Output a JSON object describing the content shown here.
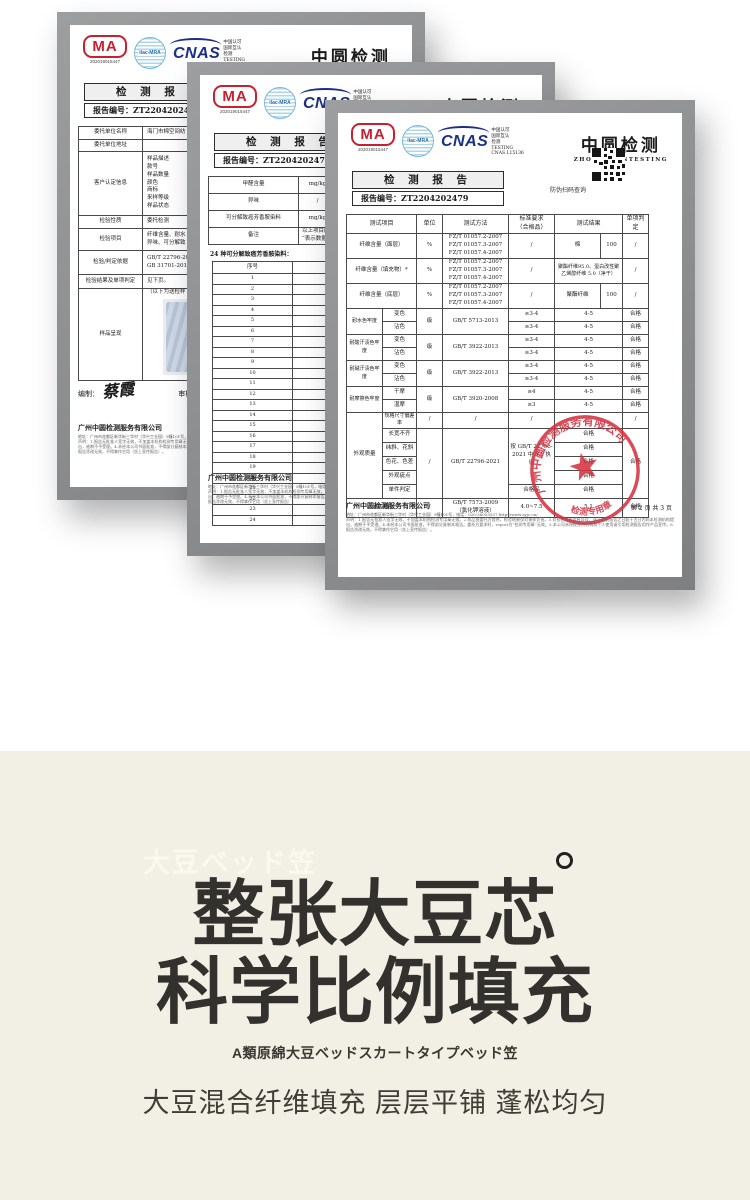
{
  "colors": {
    "cma_red": "#c8202f",
    "cnas_blue": "#1b2f86",
    "ilac_blue": "#79b7d8",
    "stamp_red": "#d5303f",
    "hero_bg": "#f2efe5",
    "hero_title": "#32312d"
  },
  "cert_common": {
    "cma_label": "MA",
    "cma_number": "202019015447",
    "ilac_label": "ilac-MRA",
    "cnas_label": "CNAS",
    "cnas_side_text": "中国认可\n国际互认\n检测\nTESTING\nCNAS L15136",
    "brand": "中圆检测",
    "brand_en": "ZHONGYUANTESTING",
    "report_title": "检 测 报 告",
    "report_no_label": "报告编号：",
    "report_no": "ZT2204202479",
    "qr_caption": "防伪扫码查询",
    "footer_company": "广州中圆检测服务有限公司",
    "footer_address": "地址：广州市花都区新华街三华村（华兴工业园）5幢101号，电话：020-36055537  http://www.zyjc.cn/",
    "footer_disclaimer": "声明：1.报告无批准人签字无效，不加盖本机构检测专用章无效。2.样品由委托方提供，检验结果仅对来样负责。3.对检验报告若有异议，请于收到报告之日起十五日内向本检测机构提出，逾期不予受理。4.未经本公司书面批准，不得部分复制本报告。委托方要求时，report为“检测专用章”无效。5.本公司未授权任何机构和个人使用或引用检测报告用作产品宣传。6.报告涂改无效，不得拿作它用（含上宣传报告）。",
    "page_info": "第 2 页 共 3 页"
  },
  "front": {
    "headers": [
      "测试项目",
      "单位",
      "测试方法",
      "标准要求\n（合格品）",
      "测试结果",
      "单项判定"
    ],
    "fiber_method": "FZ/T 01057.2-2007\nFZ/T 01057.3-2007\nFZ/T 01057.4-2007",
    "fiber": [
      {
        "item": "纤维含量（面层）",
        "unit": "%",
        "req": "/",
        "result_name": "棉",
        "result_val": "100",
        "judge": "/"
      },
      {
        "item": "纤维含量（填充物）*",
        "unit": "%",
        "req": "/",
        "result": "聚酯纤维95.0、蛋白改性聚乙烯醇纤维 5.0（净干）",
        "judge": "/"
      },
      {
        "item": "纤维含量（底层）",
        "unit": "%",
        "req": "/",
        "result_name": "聚酯纤维",
        "result_val": "100",
        "judge": "/"
      }
    ],
    "fastness": [
      {
        "group": "耐水色牢度",
        "unit": "级",
        "method": "GB/T 5713-2013",
        "sub1": "变色",
        "req1": "≥3-4",
        "res1": "4-5",
        "j1": "合格",
        "sub2": "沾色",
        "req2": "≥3-4",
        "res2": "4-5",
        "j2": "合格"
      },
      {
        "group": "耐酸汗渍色牢度",
        "unit": "级",
        "method": "GB/T 3922-2013",
        "sub1": "变色",
        "req1": "≥3-4",
        "res1": "4-5",
        "j1": "合格",
        "sub2": "沾色",
        "req2": "≥3-4",
        "res2": "4-5",
        "j2": "合格"
      },
      {
        "group": "耐碱汗渍色牢度",
        "unit": "级",
        "method": "GB/T 3922-2013",
        "sub1": "变色",
        "req1": "≥3-4",
        "res1": "4-5",
        "j1": "合格",
        "sub2": "沾色",
        "req2": "≥3-4",
        "res2": "4-5",
        "j2": "合格"
      },
      {
        "group": "耐摩擦色牢度",
        "unit": "级",
        "method": "GB/T 3920-2008",
        "sub1": "干摩",
        "req1": "≥4",
        "res1": "4-5",
        "j1": "合格",
        "sub2": "湿摩",
        "req2": "≥3",
        "res2": "4-5",
        "j2": "合格"
      }
    ],
    "appearance": {
      "group": "外观质量",
      "row0": {
        "item": "规格尺寸偏差率",
        "unit": "/",
        "method": "/",
        "req": "/",
        "result": "/",
        "judge": "/"
      },
      "items": [
        "长宽不齐",
        "纬斜、花斜",
        "色花、色差",
        "外观疵点",
        "单件判定"
      ],
      "unit": "/",
      "method": "GB/T 22796-2021",
      "req": "按 GB/T 22796-2021 中 4.6 执行",
      "results": [
        "合格",
        "合格",
        "合格",
        "合格",
        "合格"
      ],
      "final_req": "合格品",
      "judge": "合格"
    },
    "ph": {
      "item": "pH 值",
      "unit": "/",
      "method": "GB/T 7573-2009\n（氯化钾溶液）",
      "req": "4.0~7.5",
      "result": "5.1",
      "judge": "合格"
    },
    "stamp_ring_text": "广州中圆检测服务有限公司",
    "stamp_bottom_text": "检测专用章"
  },
  "middle": {
    "rows": [
      {
        "item": "甲醛含量",
        "unit": "mg/kg",
        "method": "GB/T 2912.1-2009\n（检出限20mg/kg）"
      },
      {
        "item": "异味",
        "unit": "/",
        "method": "GB 18401-2010"
      },
      {
        "item": "可分解致癌芳香胺染料",
        "unit": "mg/kg",
        "method": "GB/T 17592-2011"
      }
    ],
    "remark_label": "备注",
    "remark": "以上项目除纤维含量外\n“表示数据来自",
    "amine_caption": "24 种可分解致癌芳香胺染料：",
    "amine_headers": [
      "序号",
      "化学文摘号"
    ],
    "amine_rows": [
      [
        "1",
        "92-67-1"
      ],
      [
        "2",
        "92-87-5"
      ],
      [
        "3",
        "95-69-2"
      ],
      [
        "4",
        "91-59-8"
      ],
      [
        "5",
        "97-56-3"
      ],
      [
        "6",
        "106-47-8"
      ],
      [
        "7",
        "615-05-4"
      ],
      [
        "8",
        "101-77-9"
      ],
      [
        "9",
        "91-94-1"
      ],
      [
        "10",
        "119-90-4"
      ],
      [
        "11",
        "119-93-7"
      ],
      [
        "12",
        "838-88-0"
      ],
      [
        "13",
        "120-71-8"
      ],
      [
        "14",
        "101-14-4"
      ],
      [
        "15",
        "101-80-4"
      ],
      [
        "16",
        "139-65-1"
      ],
      [
        "17",
        "95-53-4"
      ],
      [
        "18",
        "95-80-7"
      ],
      [
        "19",
        "137-17-7"
      ],
      [
        "20",
        "90-04-0"
      ],
      [
        "21",
        "95-68-1"
      ],
      [
        "22",
        "87-62-7"
      ],
      [
        "23",
        "99-55-8"
      ],
      [
        "24",
        "60-09-3"
      ]
    ]
  },
  "back": {
    "rows": [
      {
        "label": "委托单位名称",
        "value": "海门市棉空间纺"
      },
      {
        "label": "委托单位地址",
        "value": ""
      },
      {
        "label": "客户认定信息",
        "value": "样品描述\n款号\n样品数量\n颜色\n商标\n来样等级\n样品状态"
      },
      {
        "label": "检验性质",
        "value": "委托检测"
      },
      {
        "label": "检验项目",
        "value": "纤维含量、耐水\n异味、可分解致"
      },
      {
        "label": "检验/判定依据",
        "value": "GB/T 22796-202\nGB 31701-2015（"
      },
      {
        "label": "检验结果及单项判定",
        "value": "见下页。"
      },
      {
        "label": "样品呈现",
        "value": "（以下为送检样"
      }
    ],
    "prepared_label": "编制：",
    "prepared_sig": "蔡霞",
    "review_label": "审核：",
    "review_sig": "曾"
  },
  "hero": {
    "tag": "大豆ベッド笠",
    "title_line1": "整张大豆芯",
    "title_line2": "科学比例填充",
    "subtitle": "A類原綿大豆ベッドスカートタイプベッド笠",
    "description": "大豆混合纤维填充 层层平铺 蓬松均匀"
  }
}
